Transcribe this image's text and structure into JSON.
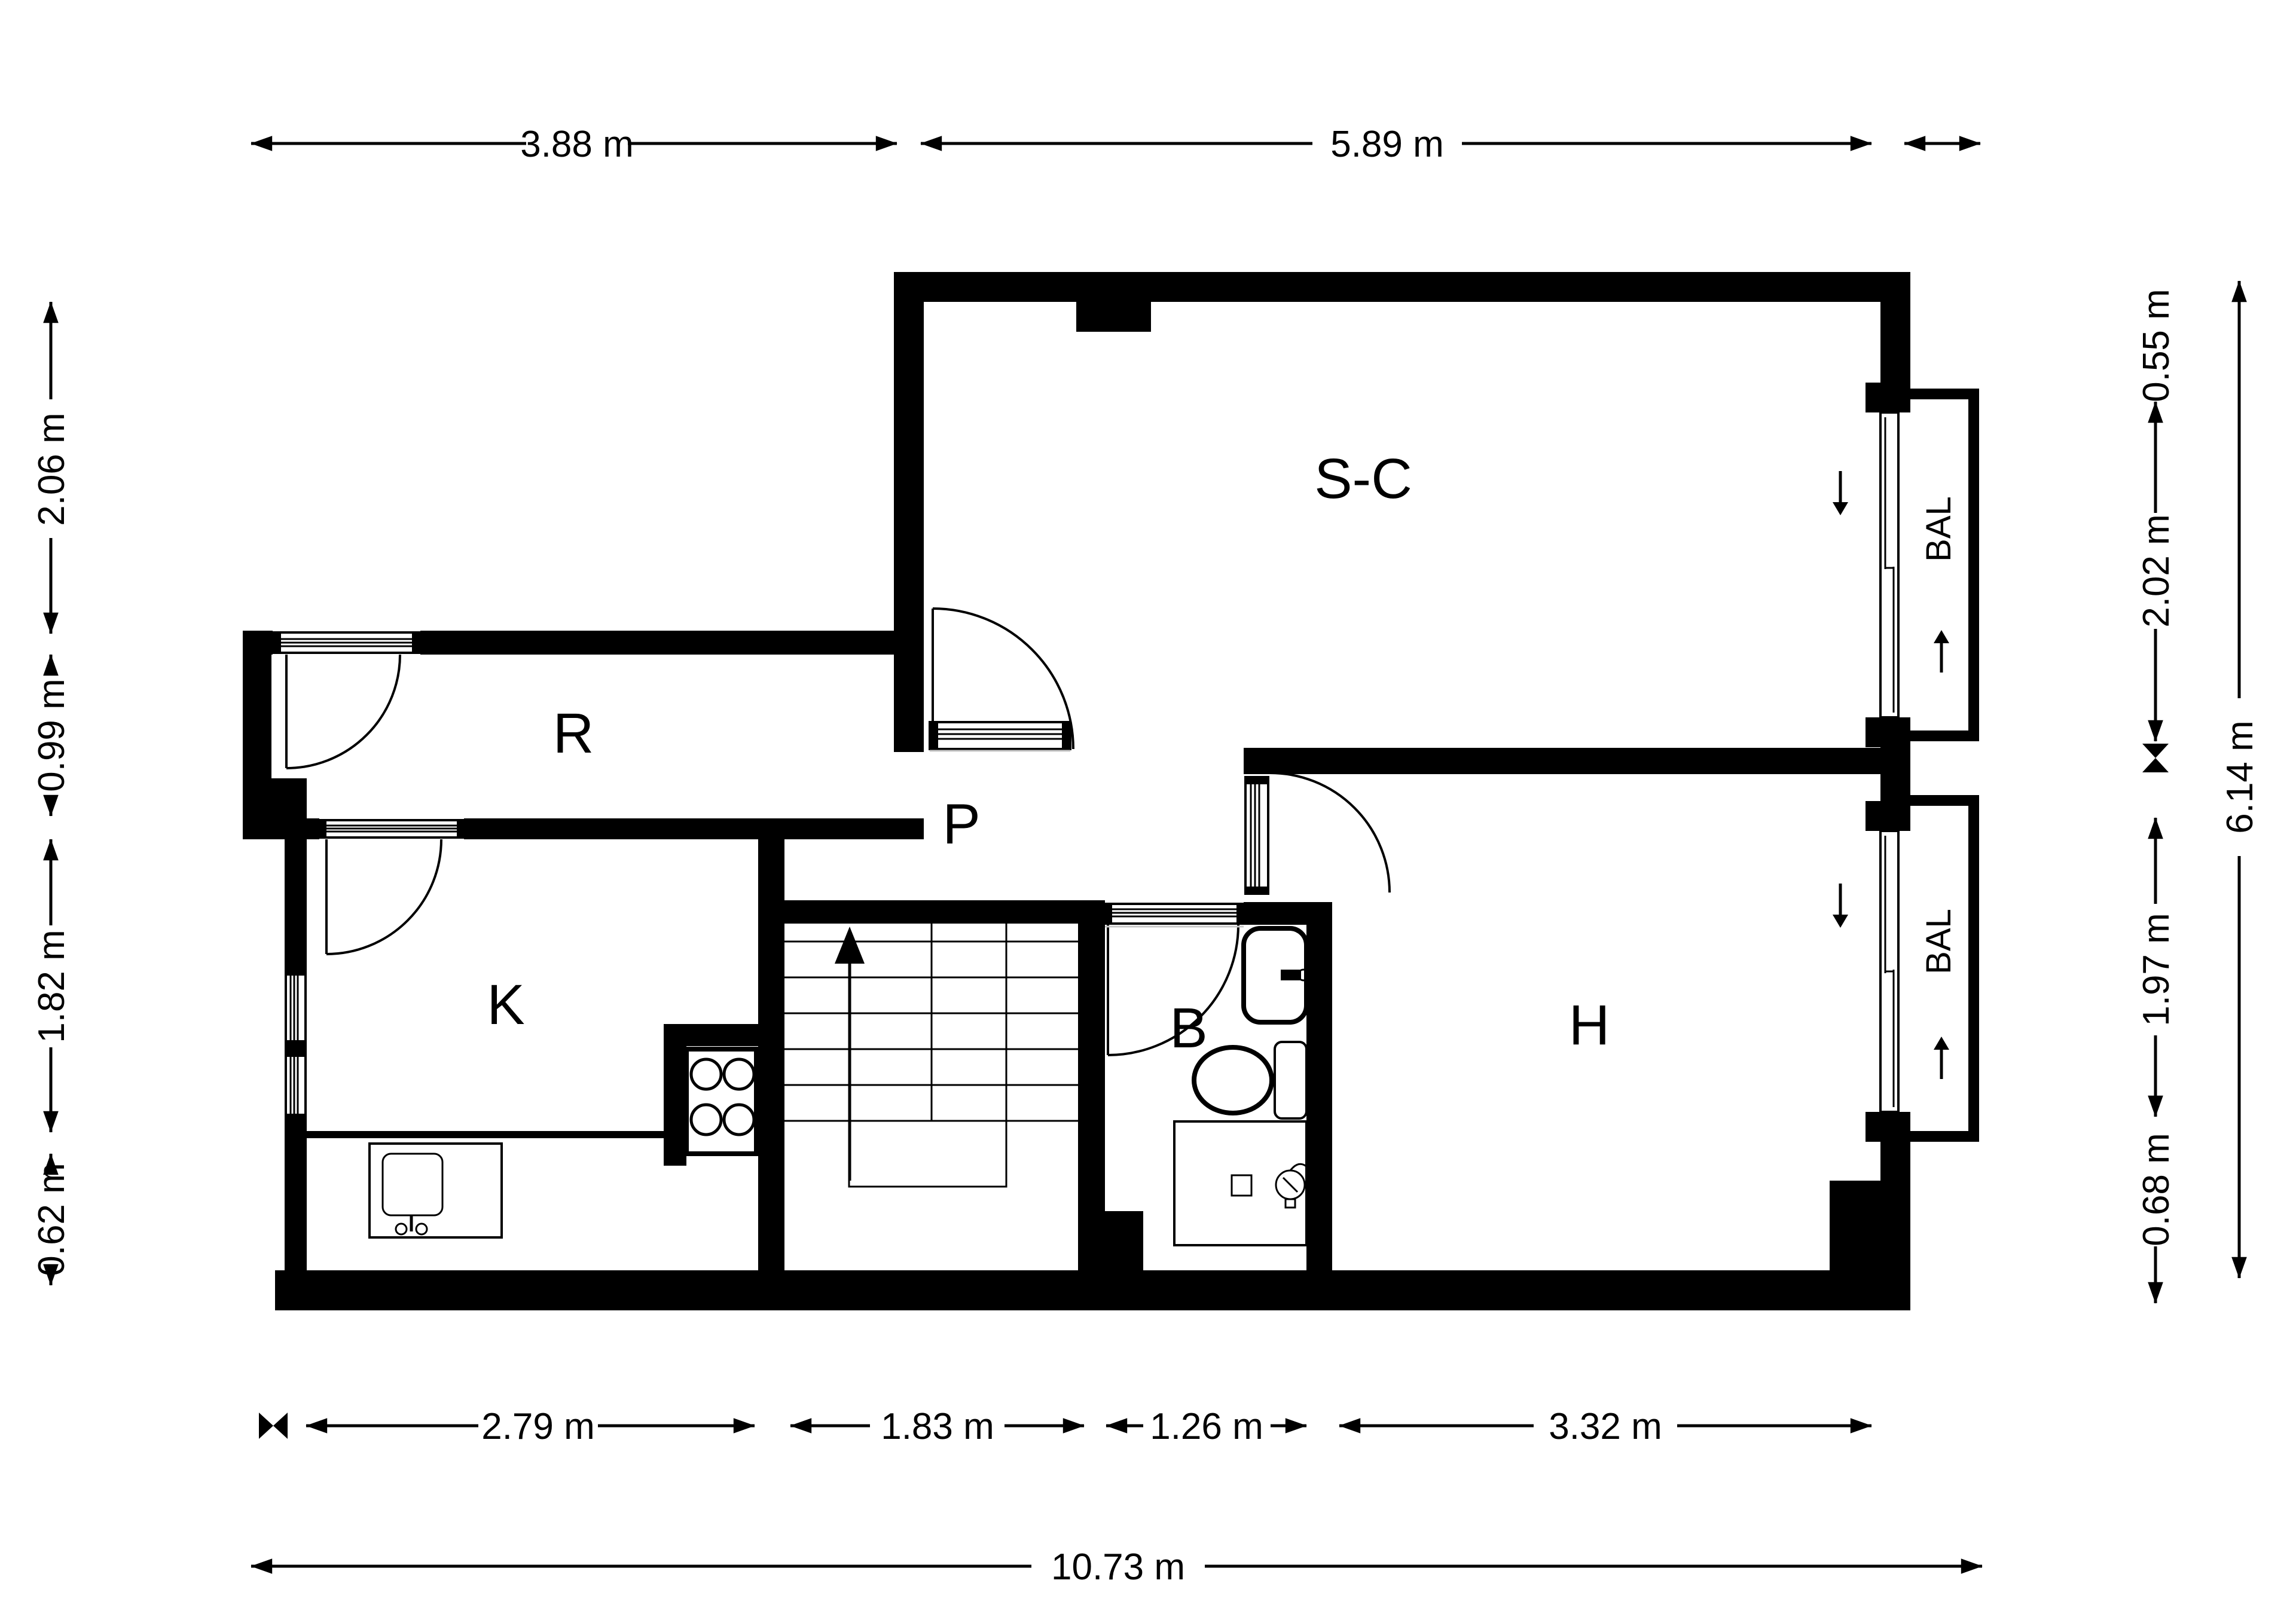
{
  "plan": {
    "type": "apartment-floor-plan",
    "colors": {
      "wall": "#000000",
      "background": "#ffffff",
      "line": "#000000"
    },
    "rooms": [
      {
        "id": "living",
        "label": "S-C"
      },
      {
        "id": "hall",
        "label": "R"
      },
      {
        "id": "passage",
        "label": "P"
      },
      {
        "id": "kitchen",
        "label": "K"
      },
      {
        "id": "bathroom",
        "label": "B"
      },
      {
        "id": "bedroom",
        "label": "H"
      }
    ],
    "balcony": {
      "label": "BAL"
    },
    "features": [
      "stairs-up-arrow",
      "balcony-sliding-doors",
      "stove",
      "sink",
      "washbasin",
      "toilet",
      "shower"
    ]
  },
  "dimensions": {
    "top": [
      {
        "label": "3.88 m"
      },
      {
        "label": "5.89 m"
      },
      {
        "label": ""
      }
    ],
    "bottom": [
      {
        "label": "2.79 m"
      },
      {
        "label": "1.83 m"
      },
      {
        "label": "1.26 m"
      },
      {
        "label": "3.32 m"
      }
    ],
    "bottom_total": {
      "label": "10.73 m"
    },
    "left": [
      {
        "label": "2.06 m"
      },
      {
        "label": "0.99 m"
      },
      {
        "label": "1.82 m"
      },
      {
        "label": "0.62 m"
      }
    ],
    "right": [
      {
        "label": "0.55 m"
      },
      {
        "label": "2.02 m"
      },
      {
        "label": "1.97 m"
      },
      {
        "label": "0.68 m"
      }
    ],
    "right_total": {
      "label": "6.14 m"
    }
  }
}
